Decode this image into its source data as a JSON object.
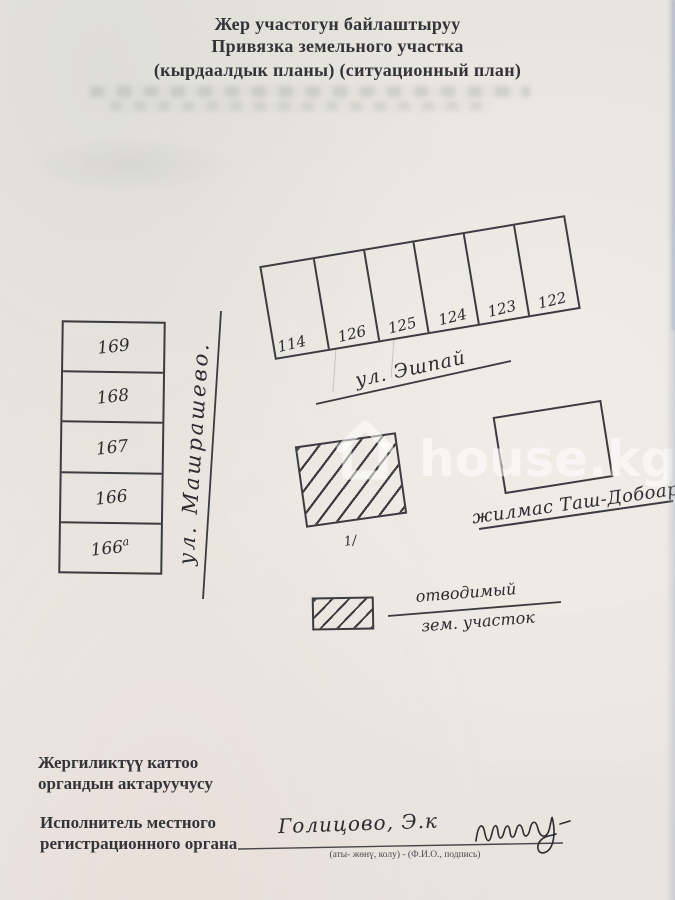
{
  "document": {
    "title_ky": "Жер участогун байлаштыруу",
    "title_ru": "Привязка земельного участка",
    "title_sub": "(кырдаалдык планы) (ситуационный план)"
  },
  "plan": {
    "top_row_plots": [
      "114",
      "126",
      "125",
      "124",
      "123",
      "122"
    ],
    "left_column_plots": [
      {
        "label": "169",
        "sup": ""
      },
      {
        "label": "168",
        "sup": ""
      },
      {
        "label": "167",
        "sup": ""
      },
      {
        "label": "166",
        "sup": ""
      },
      {
        "label": "166",
        "sup": "а"
      }
    ],
    "street_vertical": "ул. Машрашево.",
    "street_horizontal": "ул. Эшпай",
    "district_label": "жилмас Таш-Добоар",
    "plot_mark": "1/",
    "legend": {
      "term_line1": "отводимый",
      "term_line2": "зем. участок"
    }
  },
  "watermark": {
    "text": "house.kg",
    "icon": "house-icon",
    "color": "rgba(255,255,255,0.55)"
  },
  "footer": {
    "registrar_ky_line1": "Жергиликтүү каттоо",
    "registrar_ky_line2": "органдын актаруучусу",
    "registrar_ru_line1": "Исполнитель местного",
    "registrar_ru_line2": "регистрационного органа",
    "signature_name": "Голицово, Э.к",
    "signature_caption": "(аты- жөнү, колу) - (Ф.И.О., подпись)"
  },
  "colors": {
    "ink": "#3c3c40",
    "paper": "#e9e6e0"
  }
}
